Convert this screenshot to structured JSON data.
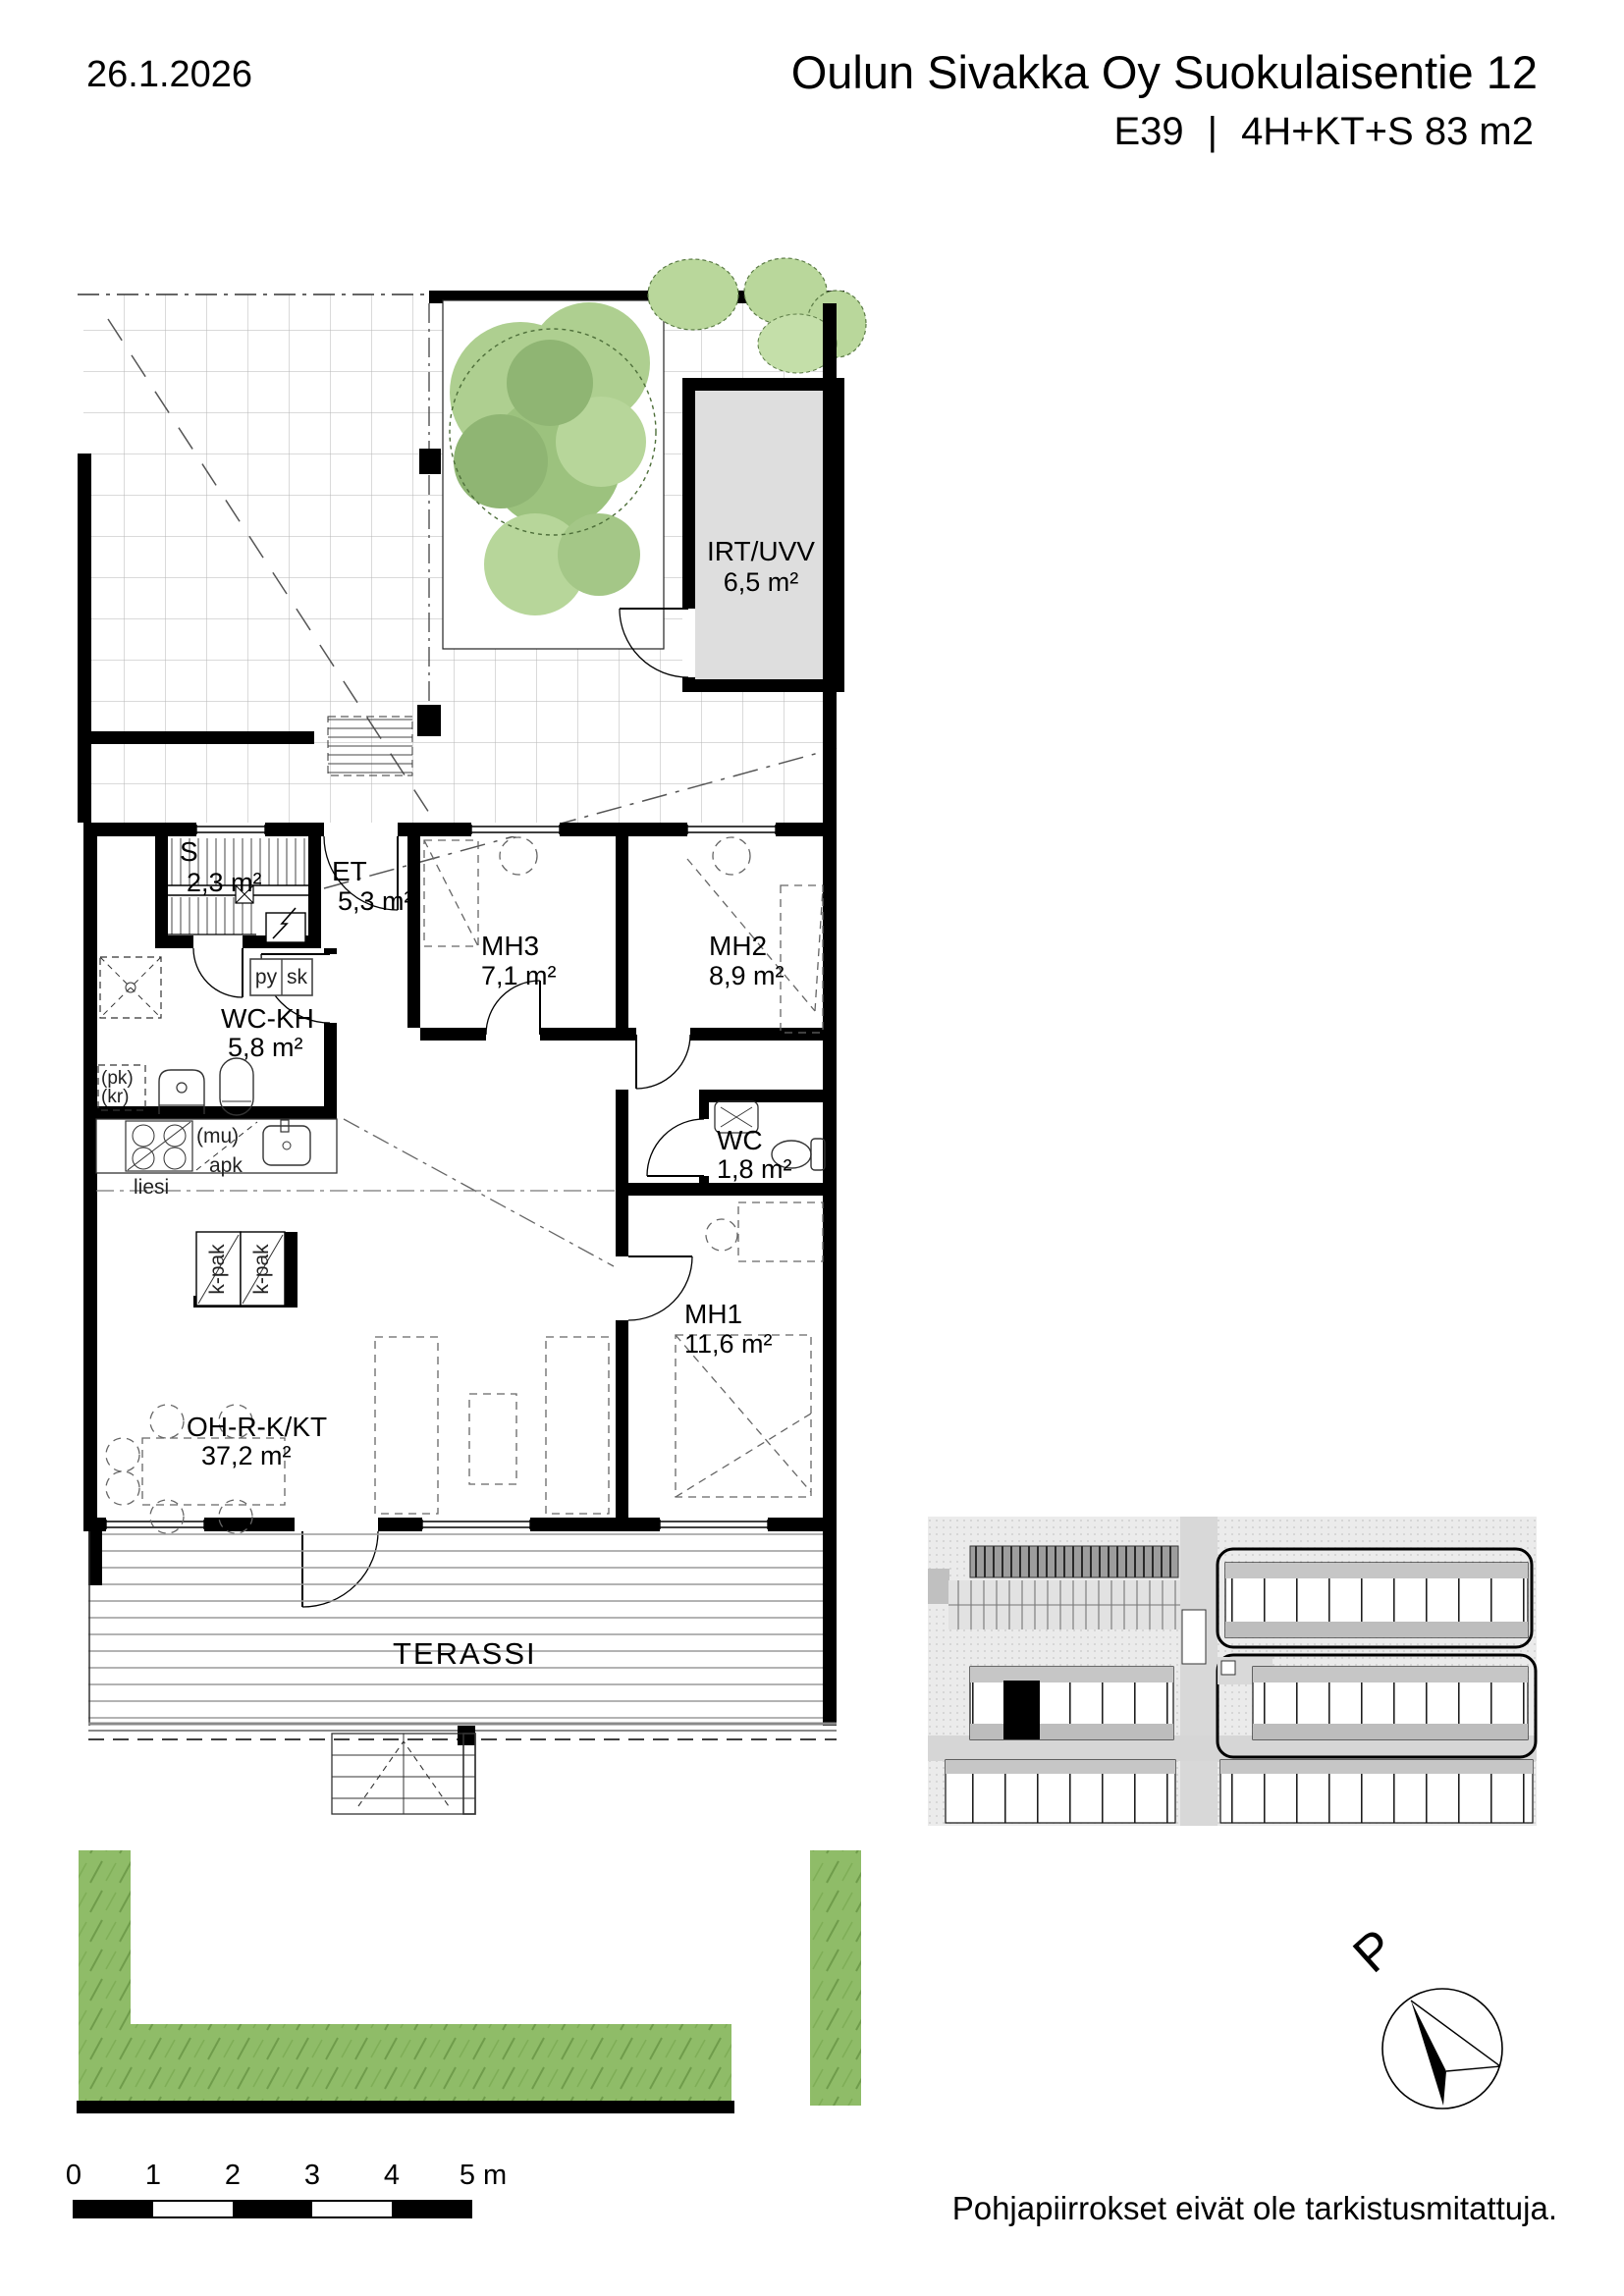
{
  "header": {
    "date": "26.1.2026",
    "title": "Oulun Sivakka Oy Suokulaisentie 12",
    "apartment_id": "E39",
    "separator": "|",
    "spec": "4H+KT+S 83 m2"
  },
  "plan": {
    "rooms": {
      "irt_uvv": {
        "name": "IRT/UVV",
        "area": "6,5 m²"
      },
      "sauna": {
        "name": "S",
        "area": "2,3 m²"
      },
      "et": {
        "name": "ET",
        "area": "5,3 m²"
      },
      "mh3": {
        "name": "MH3",
        "area": "7,1 m²"
      },
      "mh2": {
        "name": "MH2",
        "area": "8,9 m²"
      },
      "wc_kh": {
        "name": "WC-KH",
        "area": "5,8 m²"
      },
      "wc": {
        "name": "WC",
        "area": "1,8 m²"
      },
      "mh1": {
        "name": "MH1",
        "area": "11,6 m²"
      },
      "oh": {
        "name": "OH-R-K/KT",
        "area": "37,2 m²"
      },
      "terassi": {
        "name": "TERASSI"
      }
    },
    "fixtures": {
      "py": "py",
      "sk": "sk",
      "pk": "(pk)",
      "kr": "(kr)",
      "mu": "(mu)",
      "apk": "apk",
      "liesi": "liesi",
      "k_pak_1": "k-pak",
      "k_pak_2": "k-pak"
    }
  },
  "compass": {
    "north": "P"
  },
  "scalebar": {
    "ticks": [
      "0",
      "1",
      "2",
      "3",
      "4",
      "5 m"
    ]
  },
  "footer": {
    "disclaimer": "Pohjapiirrokset eivät ole tarkistusmitattuja."
  },
  "colors": {
    "wall": "#000000",
    "storage_fill": "#dedede",
    "hedge_green": "#8fbc68",
    "tree_light": "#aecf90",
    "tree_dark": "#8fb573",
    "site_bg": "#ebebeb"
  }
}
